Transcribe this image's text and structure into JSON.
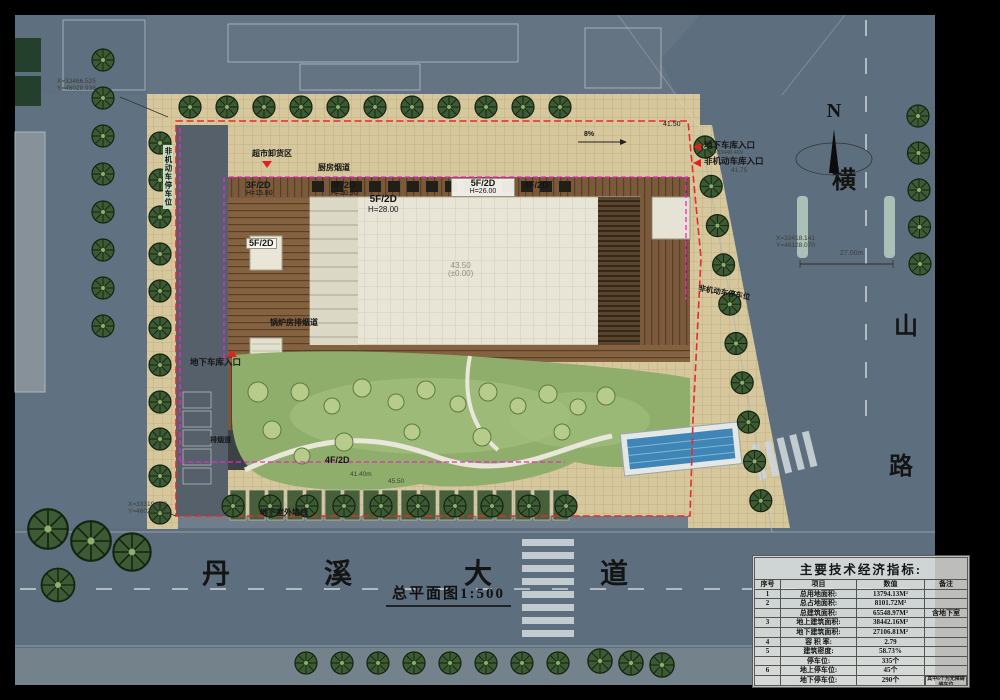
{
  "drawing": {
    "title": "总平面图1:500",
    "compass_label": "N"
  },
  "roads": {
    "south_name": [
      "丹",
      "溪",
      "大",
      "道"
    ],
    "east_name": [
      "横",
      "山",
      "路"
    ],
    "road_width_dim": "27.00m"
  },
  "site_labels": {
    "supermarket_unloading": "超市卸货区",
    "kitchen_flue": "厨房烟道",
    "boiler_flue": "锅炉房排烟道",
    "exhaust_flue": "排烟道",
    "garage_entrance_west": "地下车库入口",
    "garage_entrance_north": "地下车库入口",
    "nonmotor_garage_entrance": "非机动车库入口",
    "nonmotor_parking_east": "非机动车停车位",
    "nonmotor_parking_west": "非机动车停车位",
    "basement_wall_line": "地下室外墙线"
  },
  "building_labels": {
    "b1": {
      "f": "3F/2D",
      "h": "H=15.80"
    },
    "b2": {
      "f": "4F/2D",
      "h": "H=20.90"
    },
    "b3": {
      "f": "5F/2D",
      "h": "H=26.00"
    },
    "b4": {
      "f": "4F/2D"
    },
    "b5": {
      "f": "5F/2D",
      "h": "H=28.00"
    },
    "b6": {
      "f": "5F/2D"
    },
    "b7": {
      "f": "4F/2D"
    }
  },
  "levels": {
    "center_elev": "43.50",
    "center_elev_rel": "(±0.00)",
    "ne_corner": "41.50",
    "nonmotor_entry_elev": "41.75",
    "south_elev": "41.40m",
    "south_elev2": "45.50",
    "slope": "8%"
  },
  "coordinates": {
    "nw": [
      "X=33466.525",
      "Y=46028.938"
    ],
    "sw": [
      "X=33319.418",
      "Y=46028.371"
    ],
    "east": [
      "X=33418.141",
      "Y=46128.070"
    ],
    "north_entry": "X=33448.469"
  },
  "colors": {
    "site_redline": "#e52b2b",
    "building_outline": "#f321cf",
    "road_gray": "#5d6f7e",
    "pave_tan": "#d6c79c",
    "lawn_green": "#8fae6c",
    "pool_blue": "#3f86b6"
  },
  "table": {
    "title": "主要技术经济指标:",
    "headers": [
      "序号",
      "项目",
      "数值",
      "备注"
    ],
    "rows": [
      [
        "1",
        "总用地面积:",
        "13794.13M²",
        ""
      ],
      [
        "2",
        "总占地面积:",
        "8101.72M²",
        ""
      ],
      [
        "",
        "总建筑面积:",
        "65548.97M²",
        "含地下室"
      ],
      [
        "3",
        "地上建筑面积:",
        "38442.16M²",
        ""
      ],
      [
        "",
        "地下建筑面积:",
        "27106.81M²",
        ""
      ],
      [
        "4",
        "容 积 率:",
        "2.79",
        ""
      ],
      [
        "5",
        "建筑密度:",
        "58.73%",
        ""
      ],
      [
        "",
        "停车位:",
        "335个",
        ""
      ],
      [
        "6",
        "地上停车位:",
        "45个",
        ""
      ],
      [
        "",
        "地下停车位:",
        "290个",
        "其中6个为无障碍停车位"
      ]
    ]
  }
}
